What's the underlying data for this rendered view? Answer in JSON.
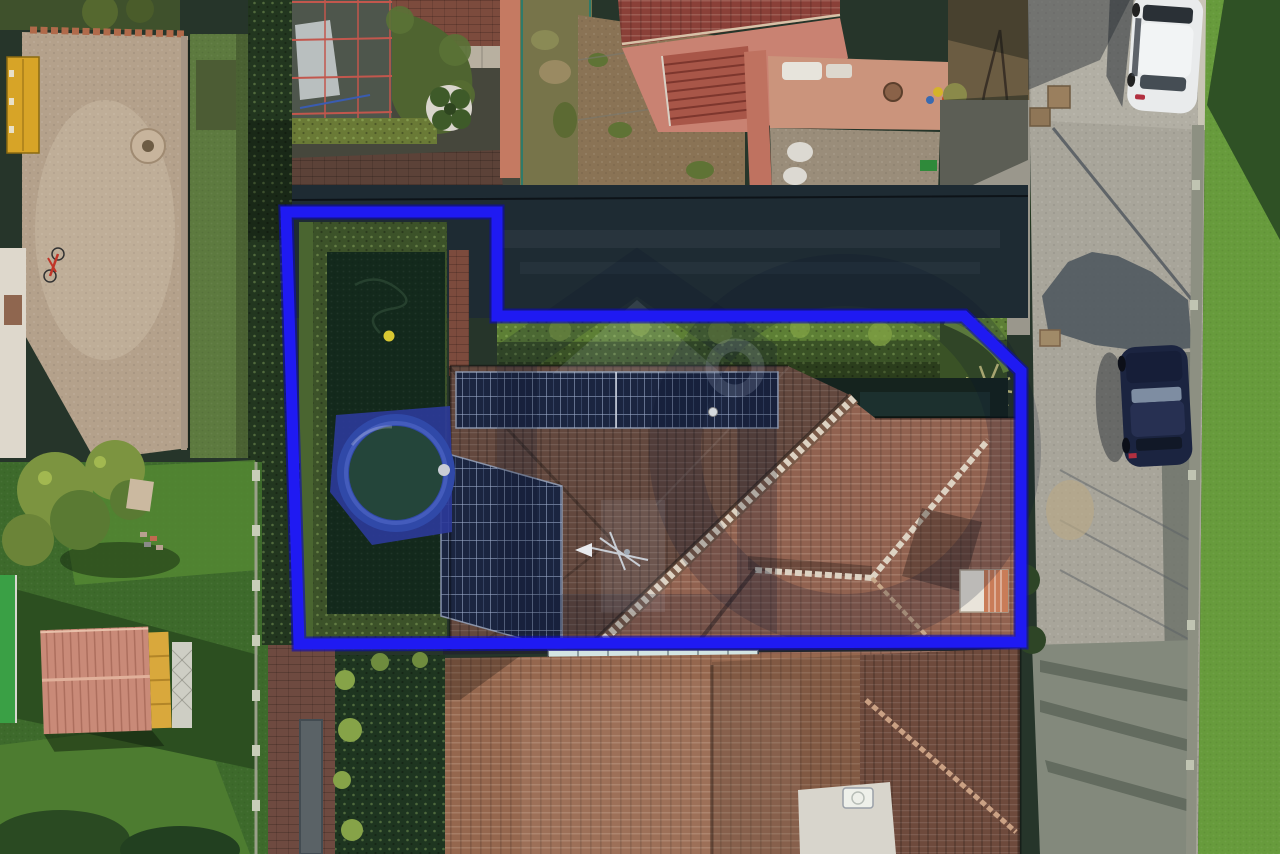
{
  "meta": {
    "kind": "aerial-drone-photograph",
    "subject": "residential property seen from directly above with a blue plot-boundary overlay and a translucent real-estate house-logo watermark",
    "width_px": 1280,
    "height_px": 854
  },
  "boundary": {
    "points": "286,212 497,212 497,316 964,316 1021,371 1021,642 299,644",
    "color": "#1f1af2",
    "underglow": "#0b08b8",
    "width": "11"
  },
  "watermark": {
    "house_outline": "rgba(12,22,46,0.22)",
    "big_ring": "rgba(12,22,46,0.20)",
    "inner_highlight": "rgba(205,220,240,0.12)",
    "door_highlight": "rgba(205,220,240,0.10)",
    "ring_highlight": "rgba(205,220,240,0.16)"
  },
  "palette": {
    "base": "#26352a",
    "road": "#a8a59a",
    "grass_sun": "#679b3c",
    "grass_shade": "#2f5125",
    "hedge_dark": "#22361f",
    "hedge_sun": "#5d7f35",
    "hedge_clump": "#7fa043",
    "lawn_dark": "#13291c",
    "garden_lawn": "#3d6a2b",
    "lawn_sunlit": "#558a33",
    "lawn_shadow": "#2c4f20",
    "roof_dark": "#63483e",
    "roof_sun": "#916250",
    "roof_lower": "#95674e",
    "roof_lower_right": "#6e4a3c",
    "ridge_light": "#ddd2c2",
    "solar": "#1b2540",
    "pool_ring": "#3049a8",
    "pool_water": "#24453a",
    "pool_tarp": "#2c3a9a",
    "courtyard": "#b4a18b",
    "terrace": "#c98272",
    "stairs": "#a85648",
    "brick_paving": "#7c4b3d",
    "brick_drive": "#6e4a40",
    "top_roof": "#8a4038",
    "dirt": "#8a7355",
    "garden_patch": "#77744a",
    "shed_roof": "#c98a78",
    "shed_wall": "#d9a83c",
    "turf": "#3aa045",
    "car_white": "#e9ebec",
    "car_dark": "#1b2440",
    "glass_dark": "#20262c",
    "driveway_shade": "#1e2b33",
    "skylight": "#bcd8d4",
    "flat_roof": "#d8d5cc",
    "yellow_door": "#d7a427",
    "wall_white": "#ded8cc",
    "well": "#c7b49c",
    "bike_red": "#c03528",
    "ball_yellow": "#d8c832",
    "chimney": "#e9e4da"
  },
  "objects": [
    {
      "name": "property-boundary-overlay",
      "label": "blue plot boundary polygon"
    },
    {
      "name": "watermark-logo",
      "label": "translucent house logo with ring"
    },
    {
      "name": "main-house-roof",
      "label": "hip roof with brown tiles"
    },
    {
      "name": "solar-panels",
      "label": "two photovoltaic arrays on shaded slope"
    },
    {
      "name": "tv-antenna",
      "label": "antenna at hip junction"
    },
    {
      "name": "chimney",
      "label": "white and terracotta chimney block"
    },
    {
      "name": "above-ground-pool",
      "label": "round pool with blue rim and cover tarp"
    },
    {
      "name": "private-garden",
      "label": "hedged lawn with brick path, hose and yellow ball"
    },
    {
      "name": "sunlit-hedge",
      "label": "hedge band along driveway"
    },
    {
      "name": "palm-plant",
      "label": "palm at boundary corner"
    },
    {
      "name": "neighbor-courtyard",
      "label": "gravel yard with yellow garage door, well and red bicycle"
    },
    {
      "name": "greenhouse-frame",
      "label": "netted frame structure"
    },
    {
      "name": "white-planter",
      "label": "round planter with shrubs"
    },
    {
      "name": "fenced-garden",
      "label": "small fenced vegetable patch"
    },
    {
      "name": "neighbor-building",
      "label": "building with red roof, terrace and external staircase"
    },
    {
      "name": "street",
      "label": "asphalt road with long shadows"
    },
    {
      "name": "white-car",
      "label": "white parked car, top right"
    },
    {
      "name": "dark-car",
      "label": "dark blue parked car, middle right"
    },
    {
      "name": "manhole-covers",
      "label": "square service covers on road"
    },
    {
      "name": "roadside-lawn",
      "label": "green verge with building shadow"
    },
    {
      "name": "lower-building-roof",
      "label": "adjacent roof with glass skylight strip"
    },
    {
      "name": "flat-roof-ac",
      "label": "white flat roof with AC unit"
    },
    {
      "name": "garden-shed",
      "label": "wooden shed with pink corrugated roof"
    },
    {
      "name": "white-trellis",
      "label": "lattice panel beside shed"
    },
    {
      "name": "garden-fence",
      "label": "wire fence with concrete posts"
    }
  ]
}
